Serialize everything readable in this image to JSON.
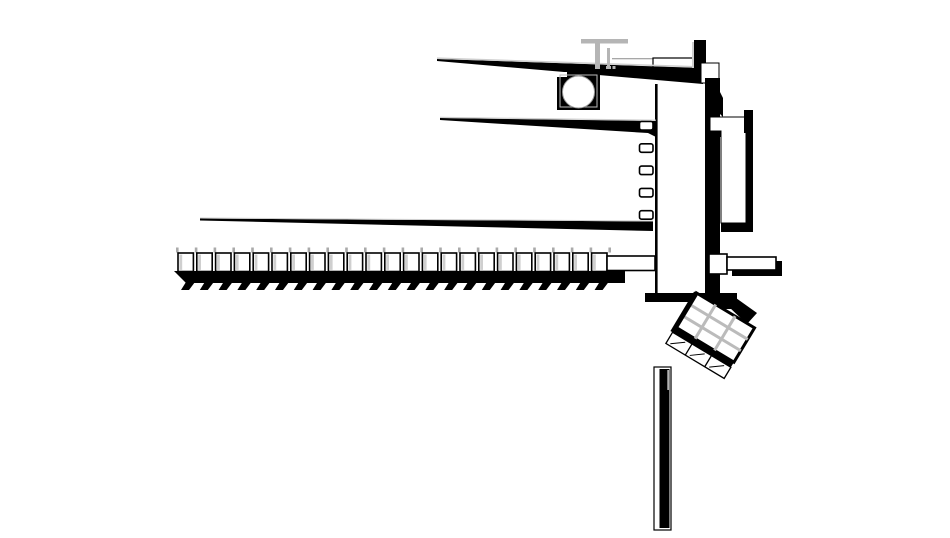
{
  "meta": {
    "kind": "architectural-plan-drawing",
    "canvas": {
      "width": 950,
      "height": 538
    }
  },
  "colors": {
    "ink": "#000000",
    "paper": "#ffffff",
    "gray": "#aaaaaa",
    "light_gray": "#cfcfcf",
    "mid_gray": "#b5b5b5"
  },
  "facade_windows": {
    "count": 5,
    "x": 639.5,
    "start_y": 121.5,
    "pitch": 22.3,
    "width": 13.5,
    "height": 8.5
  },
  "gallery_modules": {
    "count": 23,
    "start_x": 178,
    "y": 253,
    "module_width": 15.4,
    "pitch": 18.8,
    "module_height": 18.5,
    "tick_y": 247.5,
    "tick_count": 24,
    "teeth_start_x": 186,
    "teeth_pitch": 18.8,
    "teeth_end_x": 622
  },
  "pergola": {
    "rows": 3,
    "cols": 3,
    "angle_deg": 31,
    "center_x": 711.5,
    "center_y": 333.5,
    "half_width": 34,
    "grid_top": -27,
    "grid_bottom": 13,
    "band_height": 6,
    "wire_height": 13
  }
}
